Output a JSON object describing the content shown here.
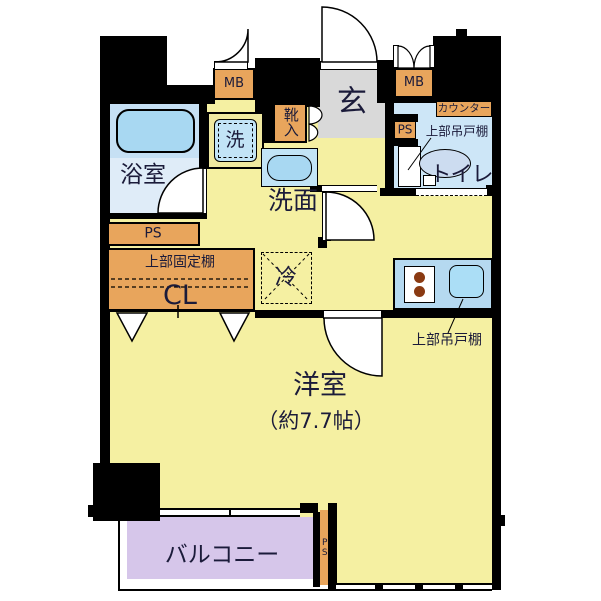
{
  "floor_plan": {
    "rooms": {
      "bathroom": "浴室",
      "washroom": "洗面",
      "entrance": "玄",
      "toilet": "トイレ",
      "main_room": "洋室",
      "main_room_size": "（約7.7帖）",
      "balcony": "バルコニー"
    },
    "labels": {
      "meter_box": "MB",
      "pipe_space": "PS",
      "shoe_cabinet": "靴入",
      "washing_machine": "洗",
      "counter": "カウンター",
      "upper_hanging_cupboard": "上部吊戸棚",
      "upper_fixed_shelf": "上部固定棚",
      "closet": "CL",
      "refrigerator": "冷"
    },
    "colors": {
      "room_yellow": "#f5f0a2",
      "wet_area_blue": "#cde6f7",
      "bath_floor_blue": "#dfecf8",
      "bath_zone_blue": "#c6e0f4",
      "fixture_blue": "#a8d8f2",
      "kitchen_counter_blue": "#b5d9f0",
      "storage_orange": "#e8a55c",
      "entrance_gray": "#d9d9d9",
      "balcony_purple": "#d6c6ea",
      "wall_black": "#000000",
      "burner_brown": "#8a3a12",
      "text_navy": "#1b1b3a"
    }
  }
}
